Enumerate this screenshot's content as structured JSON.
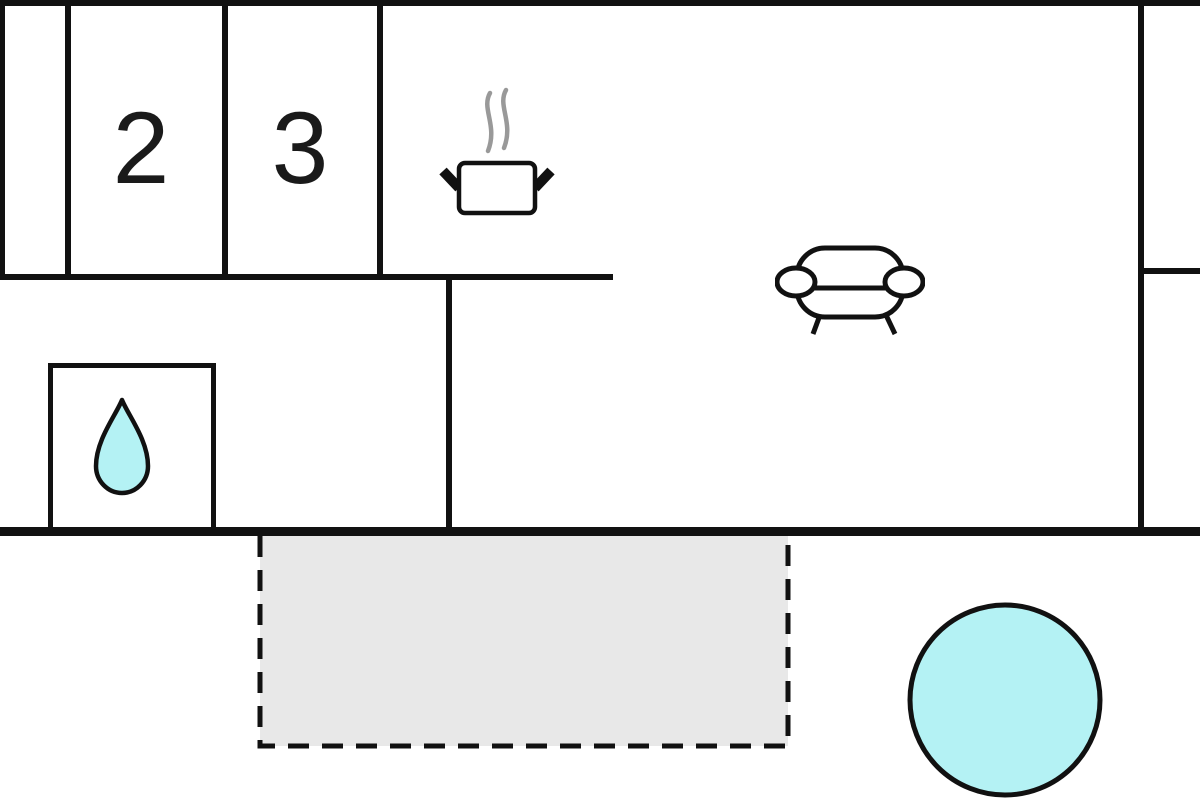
{
  "floorplan": {
    "rooms": [
      {
        "id": "room-2",
        "label": "2"
      },
      {
        "id": "room-3",
        "label": "3"
      }
    ],
    "icons": [
      {
        "name": "cooking-pot-icon"
      },
      {
        "name": "steam-icon"
      },
      {
        "name": "sofa-icon"
      },
      {
        "name": "water-drop-icon"
      },
      {
        "name": "terrace-area"
      },
      {
        "name": "pool-circle-icon"
      }
    ],
    "colors": {
      "wall": "#111111",
      "water_fill": "#b4f2f4",
      "terrace_fill": "#e8e8e8",
      "steam": "#999999",
      "background": "#ffffff",
      "label_text": "#1a1a1a"
    }
  }
}
